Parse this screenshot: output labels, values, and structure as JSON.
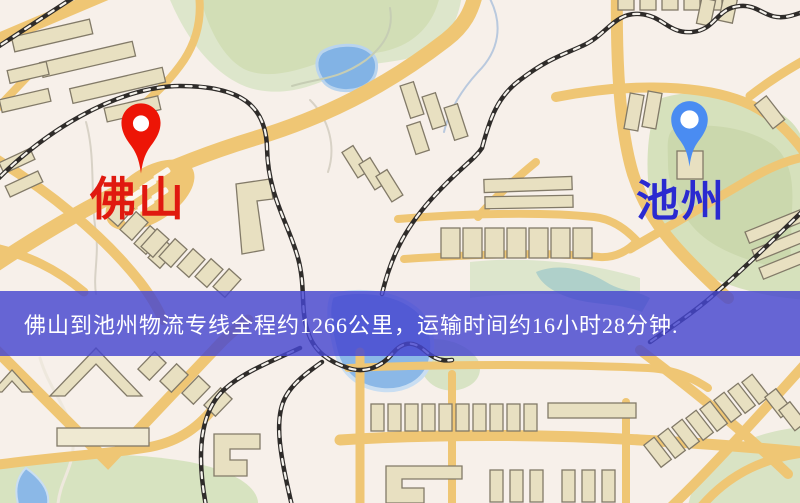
{
  "map": {
    "markers": [
      {
        "name": "foshan",
        "label": "佛山",
        "pin_color": "#ed1506",
        "label_color": "#e0190f"
      },
      {
        "name": "chizhou",
        "label": "池州",
        "pin_color": "#4a8cf2",
        "label_color": "#2a2ad0"
      }
    ],
    "banner": {
      "text": "佛山到池州物流专线全程约1266公里，运输时间约16小时28分钟.",
      "background_color": "#4545cf",
      "text_color": "#ffffff"
    },
    "palette": {
      "map_background": "#f7f0ea",
      "road": "#efc674",
      "building_fill": "#e8e0c1",
      "building_stroke": "#827a68",
      "park_green": "#d6e1bc",
      "water_blue": "#8bb8e7",
      "railway_black": "#2f2c2a"
    }
  }
}
